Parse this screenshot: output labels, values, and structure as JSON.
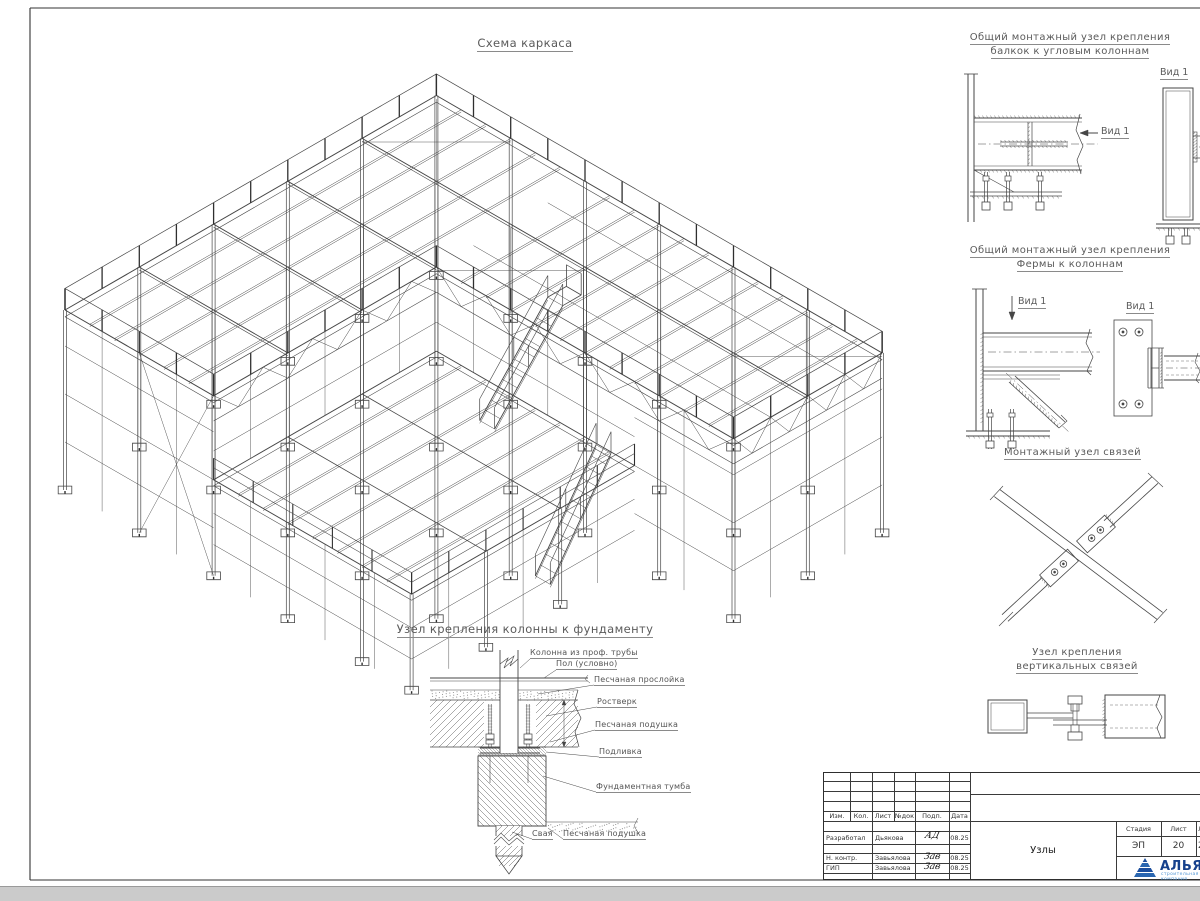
{
  "page": {
    "main_title": "Схема каркаса",
    "foundation_title": "Узел крепления колонны к фундаменту"
  },
  "details": [
    {
      "line1": "Общий монтажный узел крепления",
      "line2": "балкок к угловым колоннам",
      "arrow_label": "Вид 1",
      "view_title": "Вид 1"
    },
    {
      "line1": "Общий монтажный узел крепления",
      "line2": "Фермы к колоннам",
      "arrow_label": "Вид 1",
      "view_title": "Вид 1"
    },
    {
      "line1": "Монтажный узел связей"
    },
    {
      "line1": "Узел крепления",
      "line2": "вертикальных связей"
    }
  ],
  "foundation_labels": [
    "Колонна из проф. трубы",
    "Пол (условно)",
    "Песчаная прослойка",
    "Ростверк",
    "Песчаная подушка",
    "Подливка",
    "Фундаментная тумба",
    "Свая",
    "Песчаная подушка"
  ],
  "title_block": {
    "cols": [
      "Изм.",
      "Кол.",
      "Лист",
      "№док",
      "Подп.",
      "Дата"
    ],
    "rows": [
      {
        "role": "Разработал",
        "name": "Дьякова",
        "sig": "АД",
        "date": "08.25"
      },
      {
        "role": "Н. контр.",
        "name": "Завьялова",
        "sig": "Зав",
        "date": "08.25"
      },
      {
        "role": "ГИП",
        "name": "Завьялова",
        "sig": "Зав",
        "date": "08.25"
      }
    ],
    "doc_title": "Узлы",
    "stage": {
      "h1": "Стадия",
      "h2": "Лист",
      "h3": "Листов",
      "v1": "ЭП",
      "v2": "20",
      "v3": "2"
    },
    "logo": {
      "name": "АЛЬЯНС",
      "subtitle": "строительная компания"
    }
  },
  "colors": {
    "line": "#464646",
    "dark": "#2f2f2f",
    "text": "#5a5a5a",
    "logo_blue": "#1c4e9d",
    "logo_light": "#4f95d5"
  }
}
